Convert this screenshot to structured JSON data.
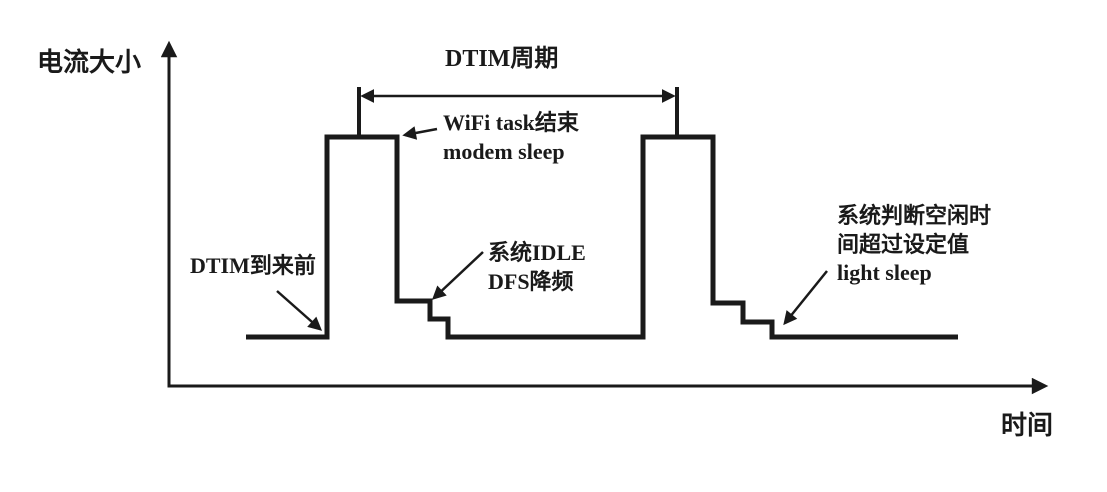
{
  "diagram": {
    "background_color": "#ffffff",
    "line_color": "#1a1a1a",
    "axes": {
      "y_label": "电流大小",
      "x_label": "时间",
      "y_label_pos": [
        37,
        46
      ],
      "x_label_pos": [
        1001,
        409
      ],
      "origin": [
        169,
        386
      ],
      "y_axis_top": [
        169,
        44
      ],
      "x_axis_end": [
        1045,
        386
      ]
    },
    "waveform": {
      "description": "current-vs-time step waveform with two DTIM wake pulses",
      "points": [
        [
          246,
          337
        ],
        [
          327,
          337
        ],
        [
          327,
          137
        ],
        [
          397,
          137
        ],
        [
          397,
          301
        ],
        [
          430,
          301
        ],
        [
          430,
          319
        ],
        [
          448,
          319
        ],
        [
          448,
          337
        ],
        [
          643,
          337
        ],
        [
          643,
          137
        ],
        [
          713,
          137
        ],
        [
          713,
          303
        ],
        [
          743,
          303
        ],
        [
          743,
          322
        ],
        [
          772,
          322
        ],
        [
          772,
          337
        ],
        [
          958,
          337
        ]
      ]
    },
    "dtim_span": {
      "label": "DTIM周期",
      "label_pos": [
        445,
        44
      ],
      "tick1_x": 359,
      "tick2_x": 677,
      "tick_top_y": 87,
      "tick_bottom_y": 137,
      "arrow_y": 96
    },
    "annotations": [
      {
        "id": "dtim-arrival",
        "lines": [
          "DTIM到来前"
        ],
        "pos": [
          190,
          252
        ],
        "arrow": {
          "from": [
            277,
            291
          ],
          "to": [
            320,
            329
          ]
        }
      },
      {
        "id": "wifi-task-end",
        "lines": [
          "WiFi task结束",
          "modem sleep"
        ],
        "pos": [
          443,
          109
        ],
        "arrow": {
          "from": [
            437,
            129
          ],
          "to": [
            405,
            135
          ]
        }
      },
      {
        "id": "sys-idle-dfs",
        "lines": [
          "系统IDLE",
          "DFS降频"
        ],
        "pos": [
          488,
          239
        ],
        "arrow": {
          "from": [
            483,
            252
          ],
          "to": [
            434,
            298
          ]
        }
      },
      {
        "id": "light-sleep",
        "lines": [
          "系统判断空闲时",
          "间超过设定值",
          "light sleep"
        ],
        "pos": [
          837,
          202
        ],
        "arrow": {
          "from": [
            827,
            271
          ],
          "to": [
            785,
            323
          ]
        }
      }
    ]
  }
}
